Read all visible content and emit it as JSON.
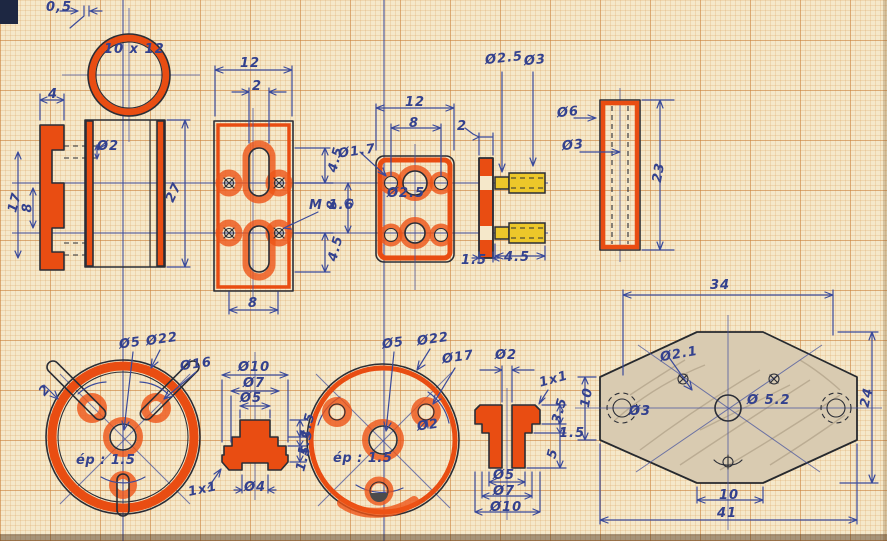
{
  "colors": {
    "paper": "#f5e8ca",
    "grid_minor": "#d69650",
    "grid_major": "#c87d37",
    "ink_blue": "#33418e",
    "outline_black": "#2a2d36",
    "marker_orange": "#e94d12",
    "marker_yellow": "#ecc72a",
    "pencil_shade": "#d9cbb1"
  },
  "labels": [
    {
      "t": "0,5",
      "x": 46,
      "y": 1
    },
    {
      "t": "10 x 12",
      "x": 104,
      "y": 43
    },
    {
      "t": "4",
      "x": 48,
      "y": 88
    },
    {
      "t": "12",
      "x": 240,
      "y": 57
    },
    {
      "t": "2",
      "x": 252,
      "y": 80
    },
    {
      "t": "Ø2",
      "x": 97,
      "y": 140
    },
    {
      "t": "17",
      "x": 5,
      "y": 196,
      "rot": -75
    },
    {
      "t": "8",
      "x": 23,
      "y": 201,
      "rot": -90
    },
    {
      "t": "27",
      "x": 164,
      "y": 186,
      "rot": -65
    },
    {
      "t": "12",
      "x": 405,
      "y": 96
    },
    {
      "t": "8",
      "x": 409,
      "y": 117
    },
    {
      "t": "Ø1.7",
      "x": 338,
      "y": 145,
      "rot": -8
    },
    {
      "t": "Ø2.5",
      "x": 387,
      "y": 187
    },
    {
      "t": "8",
      "x": 328,
      "y": 198,
      "rot": -90
    },
    {
      "t": "4.5",
      "x": 323,
      "y": 153,
      "rot": -75
    },
    {
      "t": "4.5",
      "x": 323,
      "y": 242,
      "rot": -75
    },
    {
      "t": "M 1.6",
      "x": 309,
      "y": 199
    },
    {
      "t": "8",
      "x": 248,
      "y": 297
    },
    {
      "t": "Ø2.5",
      "x": 485,
      "y": 52,
      "rot": -6
    },
    {
      "t": "Ø3",
      "x": 524,
      "y": 54,
      "rot": -6
    },
    {
      "t": "2",
      "x": 457,
      "y": 120
    },
    {
      "t": "Ø6",
      "x": 557,
      "y": 106,
      "rot": -6
    },
    {
      "t": "Ø3",
      "x": 562,
      "y": 139,
      "rot": -6
    },
    {
      "t": "23",
      "x": 649,
      "y": 166,
      "rot": -80
    },
    {
      "t": "1.5",
      "x": 461,
      "y": 254
    },
    {
      "t": "4.5",
      "x": 504,
      "y": 251
    },
    {
      "t": "Ø5",
      "x": 119,
      "y": 337,
      "rot": -8
    },
    {
      "t": "Ø22",
      "x": 146,
      "y": 333,
      "rot": -8
    },
    {
      "t": "Ø16",
      "x": 180,
      "y": 358,
      "rot": -8
    },
    {
      "t": "2",
      "x": 40,
      "y": 384,
      "rot": -50
    },
    {
      "t": "ép : 1.5",
      "x": 76,
      "y": 454,
      "cls": "it"
    },
    {
      "t": "1x1",
      "x": 188,
      "y": 483,
      "rot": -12
    },
    {
      "t": "Ø10",
      "x": 238,
      "y": 361
    },
    {
      "t": "Ø7",
      "x": 243,
      "y": 377
    },
    {
      "t": "Ø5",
      "x": 240,
      "y": 392
    },
    {
      "t": "1.5",
      "x": 295,
      "y": 419,
      "rot": -75
    },
    {
      "t": "1.5",
      "x": 293,
      "y": 436,
      "rot": -75
    },
    {
      "t": "1.5",
      "x": 291,
      "y": 452,
      "rot": -75
    },
    {
      "t": "Ø4",
      "x": 244,
      "y": 481
    },
    {
      "t": "Ø5",
      "x": 382,
      "y": 337,
      "rot": -8
    },
    {
      "t": "Ø22",
      "x": 417,
      "y": 333,
      "rot": -8
    },
    {
      "t": "Ø17",
      "x": 442,
      "y": 351,
      "rot": -8
    },
    {
      "t": "Ø2",
      "x": 417,
      "y": 419,
      "rot": -8
    },
    {
      "t": "ép : 1.5",
      "x": 333,
      "y": 452,
      "cls": "it"
    },
    {
      "t": "Ø2",
      "x": 495,
      "y": 349
    },
    {
      "t": "1x1",
      "x": 539,
      "y": 373,
      "rot": -15
    },
    {
      "t": "3.5",
      "x": 547,
      "y": 404,
      "rot": -75
    },
    {
      "t": "1.5",
      "x": 559,
      "y": 427
    },
    {
      "t": "5",
      "x": 548,
      "y": 447,
      "rot": -75
    },
    {
      "t": "Ø5",
      "x": 493,
      "y": 469
    },
    {
      "t": "Ø7",
      "x": 493,
      "y": 485
    },
    {
      "t": "Ø10",
      "x": 490,
      "y": 501
    },
    {
      "t": "10",
      "x": 577,
      "y": 391,
      "rot": -80
    },
    {
      "t": "34",
      "x": 710,
      "y": 279
    },
    {
      "t": "Ø2.1",
      "x": 660,
      "y": 348,
      "rot": -10
    },
    {
      "t": "Ø 5.2",
      "x": 747,
      "y": 394
    },
    {
      "t": "Ø3",
      "x": 629,
      "y": 405
    },
    {
      "t": "24",
      "x": 857,
      "y": 391,
      "rot": -78
    },
    {
      "t": "10",
      "x": 719,
      "y": 489
    },
    {
      "t": "41",
      "x": 717,
      "y": 507
    }
  ]
}
